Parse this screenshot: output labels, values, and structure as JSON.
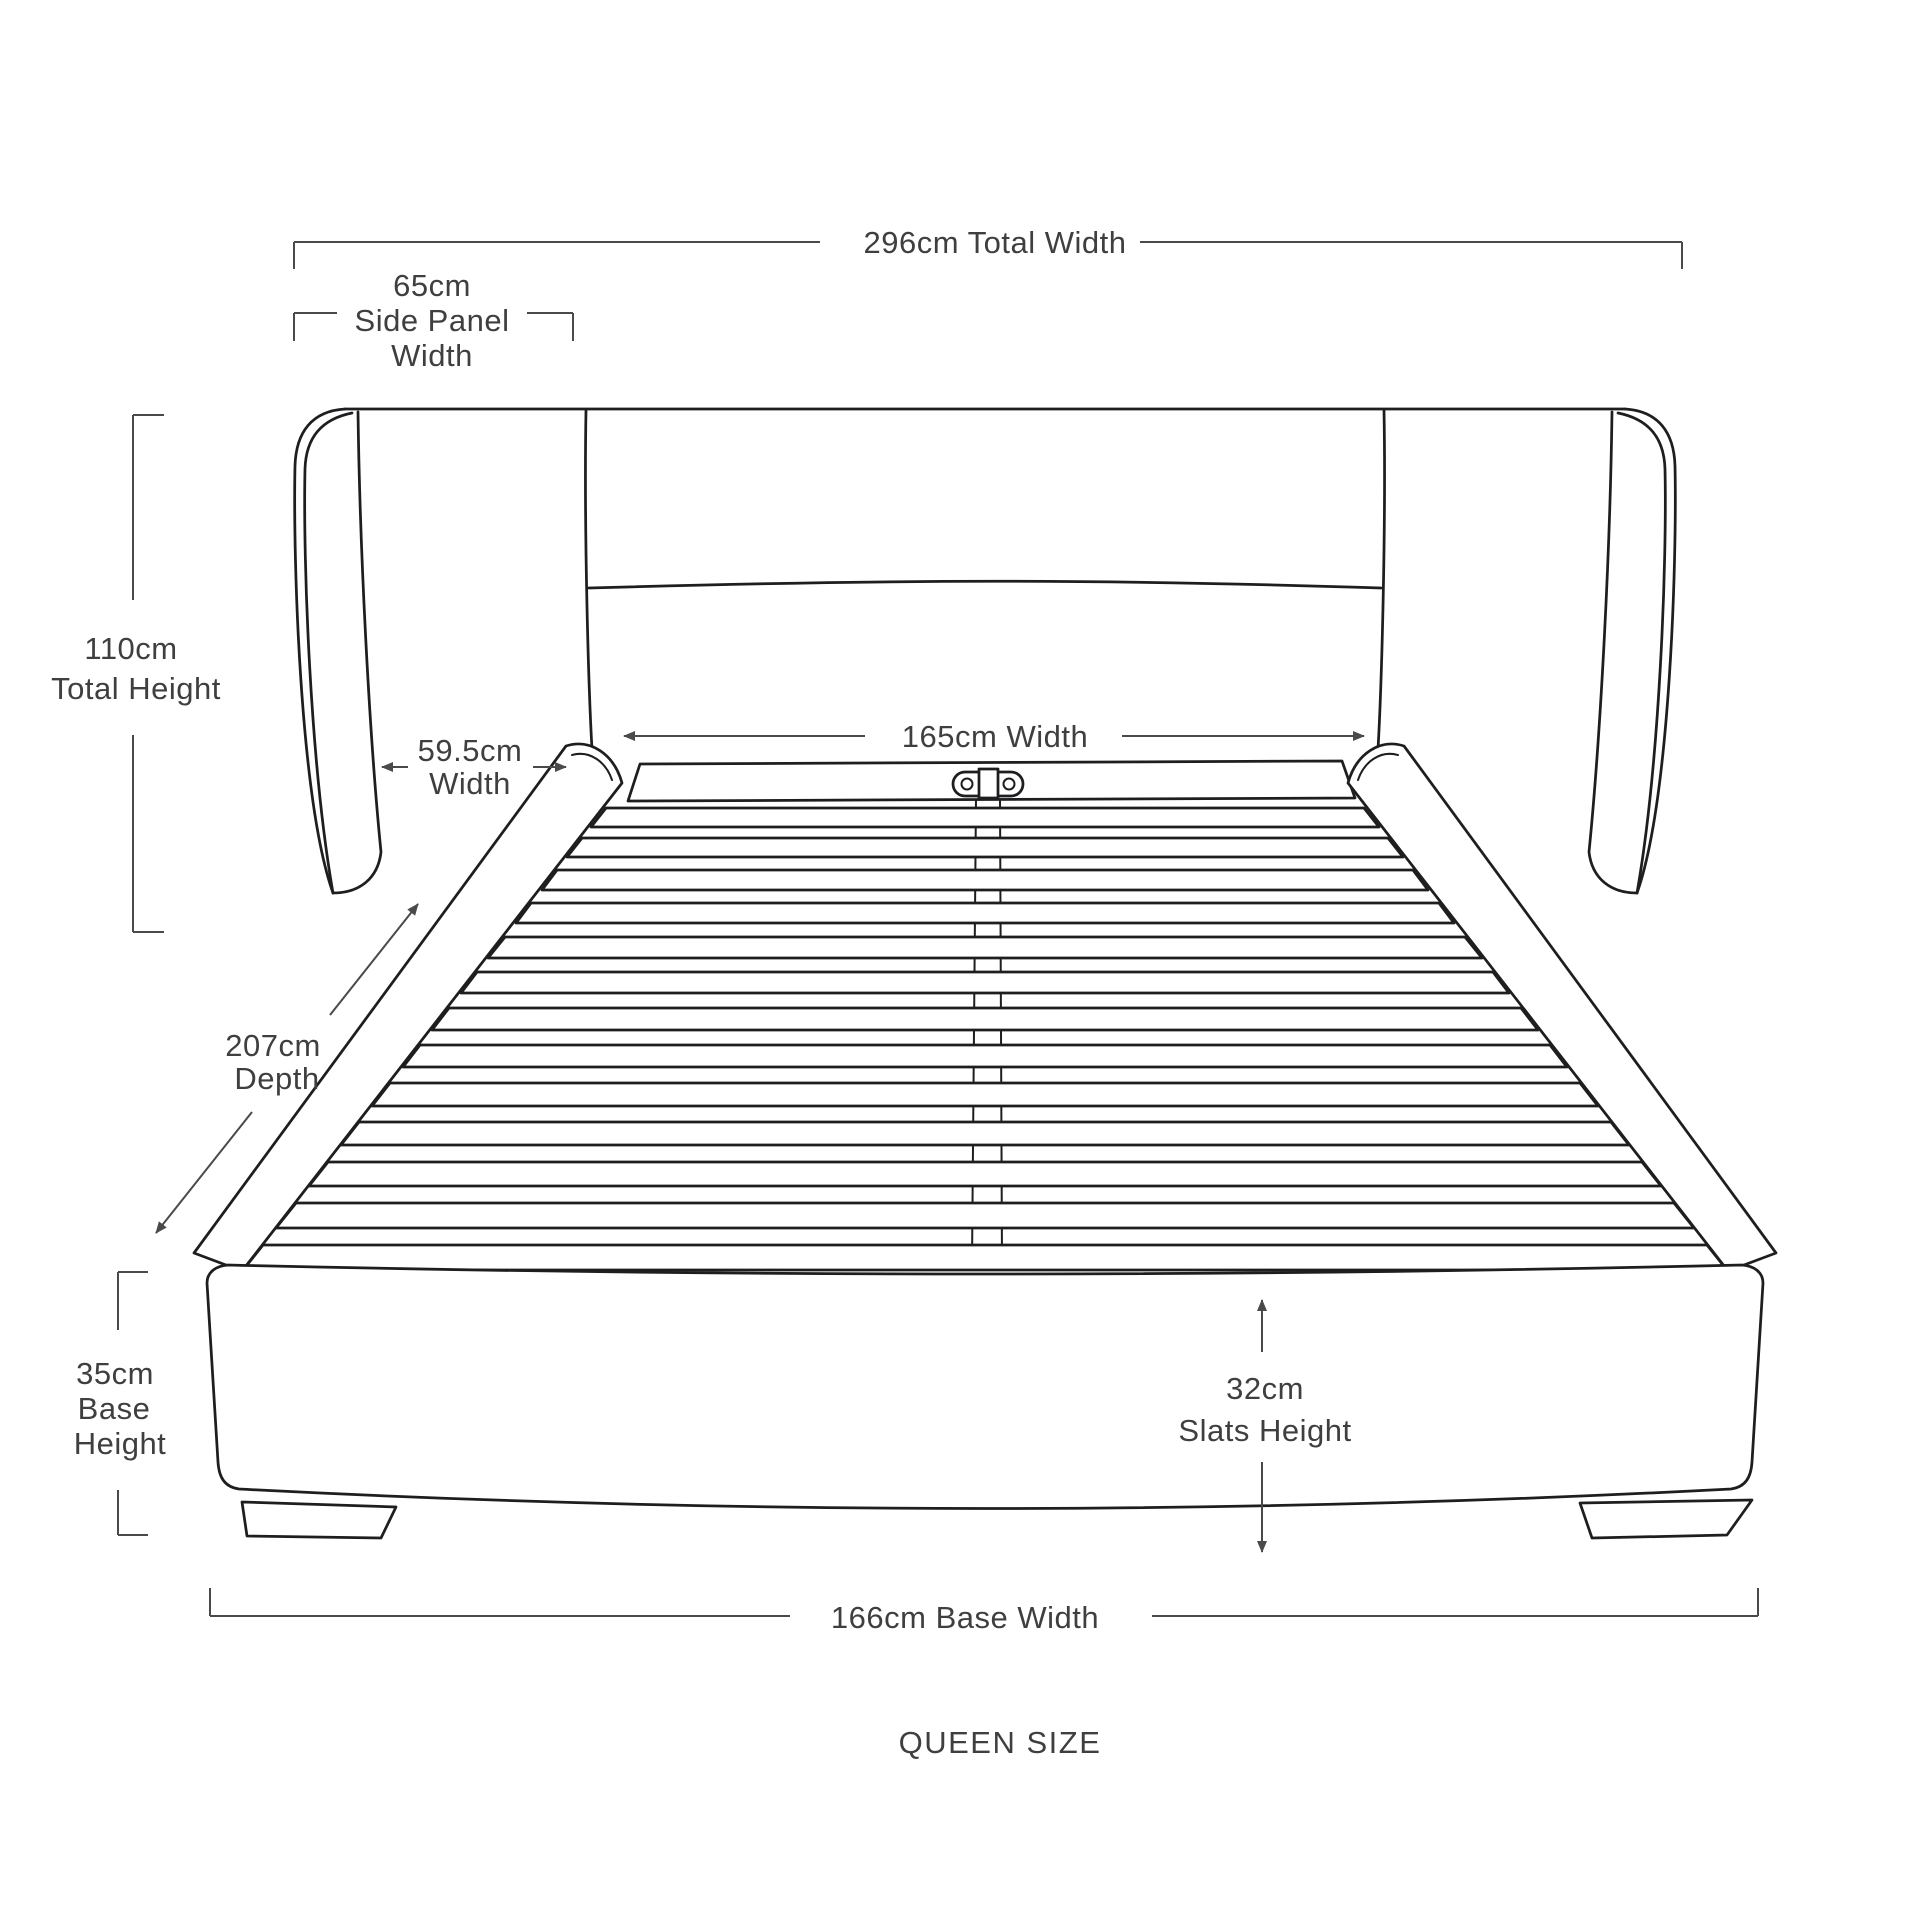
{
  "diagram": {
    "title": "QUEEN SIZE",
    "subject": "upholstered bed frame with winged headboard, slatted base and plinth feet",
    "view": "front perspective line drawing",
    "colors": {
      "background": "#ffffff",
      "drawing_outline": "#1e1e20",
      "dimension_lines": "#4a4a4c",
      "label_text": "#3f3f41"
    },
    "measurements": [
      {
        "name": "Total Width",
        "value_cm": 296,
        "display": "296cm Total Width"
      },
      {
        "name": "Side Panel Width",
        "value_cm": 65,
        "display": "65cm Side Panel Width"
      },
      {
        "name": "Total Height",
        "value_cm": 110,
        "display": "110cm Total Height"
      },
      {
        "name": "Side Panel Depth Width",
        "value_cm": 59.5,
        "display": "59.5cm Width"
      },
      {
        "name": "Headboard Inner Width",
        "value_cm": 165,
        "display": "165cm Width"
      },
      {
        "name": "Depth",
        "value_cm": 207,
        "display": "207cm Depth"
      },
      {
        "name": "Base Height",
        "value_cm": 35,
        "display": "35cm Base Height"
      },
      {
        "name": "Slats Height",
        "value_cm": 32,
        "display": "32cm Slats Height"
      },
      {
        "name": "Base Width",
        "value_cm": 166,
        "display": "166cm Base Width"
      }
    ],
    "dims": {
      "total_width": "296cm Total Width",
      "side_panel_value": "65cm",
      "side_panel_line2": "Side Panel",
      "side_panel_line3": "Width",
      "total_height_value": "110cm",
      "total_height_label": "Total Height",
      "panel_width_value": "59.5cm",
      "panel_width_label": "Width",
      "headboard_width": "165cm Width",
      "depth_value": "207cm",
      "depth_label": "Depth",
      "base_height_value": "35cm",
      "base_height_line2": "Base",
      "base_height_line3": "Height",
      "slats_height_value": "32cm",
      "slats_height_label": "Slats Height",
      "base_width": "166cm Base Width",
      "size": "QUEEN SIZE"
    }
  }
}
